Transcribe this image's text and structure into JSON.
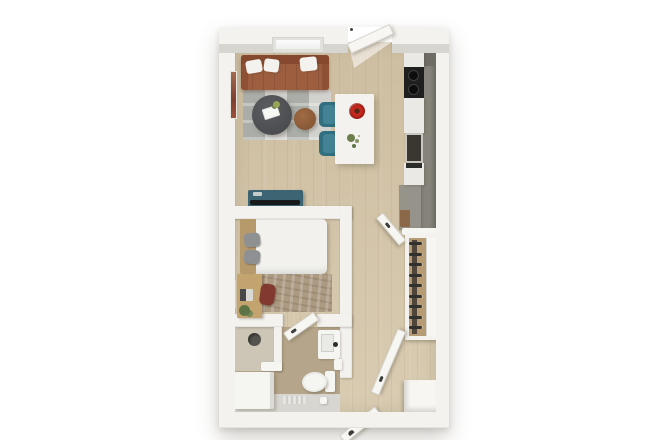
{
  "scene": {
    "description": "3D top-down render of a studio apartment floor plan",
    "background": "#ffffff"
  },
  "palette": {
    "wall": "#edecE8",
    "wallFace": "#f3f2ef",
    "doorWhite": "#f7f6f3",
    "floorA": "#cdbda0",
    "floorB": "#d9ccb2",
    "rugBase": "#c6c6c2",
    "sofa": "#9d5e40",
    "sofaDark": "#86492f",
    "pillow": "#f3f2ee",
    "coffeeTable": "#4e5053",
    "sideTable": "#95643f",
    "chairTeal": "#2f6f80",
    "chairTealLight": "#428294",
    "island": "#f3f2ef",
    "flowerRed": "#c3271d",
    "plantGreen": "#6d7d4b",
    "counter": "#85837a",
    "counterDark": "#6e6c64",
    "counterLow": "#96938a",
    "appliance": "#eae9e5",
    "cooktop": "#1f1f1f",
    "sinkDark": "#39372f",
    "credenza": "#3c6472",
    "tvBlack": "#17191b",
    "headboard": "#b79a6b",
    "duvet": "#f2f1ed",
    "pillowGray": "#8e9091",
    "bedRug": "#ac9a82",
    "desk": "#c4a46e",
    "deskChair": "#82392f",
    "laptopScreen": "#46484a",
    "mirror": "#6f6f6a",
    "bathFloor": "#b5a58a",
    "showerFloor": "#cdc6b7",
    "tileLight": "#d8d6d1",
    "showerHead": "#55534e",
    "hanger": "#30302e",
    "closetWood": "#b59c74",
    "rodShadow": "#50453a",
    "artRed": "#9c5038",
    "fixture": "#f5f5f2"
  },
  "rooms": [
    {
      "id": "living-dining",
      "furniture": [
        "sofa",
        "throw-pillows",
        "plaid-rug",
        "coffee-table",
        "side-table",
        "dining-chairs",
        "island-table",
        "flower-bowl",
        "potted-plant",
        "tv-console",
        "wall-art",
        "window"
      ]
    },
    {
      "id": "kitchen",
      "furniture": [
        "counter-run",
        "cooktop",
        "kitchen-sink",
        "refrigerator",
        "cabinets"
      ]
    },
    {
      "id": "bedroom",
      "furniture": [
        "bed",
        "headboard",
        "gray-pillows",
        "textured-rug",
        "desk",
        "laptop",
        "desk-chair",
        "floor-plant",
        "leaning-mirror",
        "door"
      ]
    },
    {
      "id": "bathroom",
      "furniture": [
        "shower",
        "shower-head",
        "vanity-cabinet",
        "toilet",
        "wall-sink",
        "bath-mat",
        "toilet-paper"
      ]
    },
    {
      "id": "closet",
      "furniture": [
        "hanger-rod",
        "hangers",
        "double-doors",
        "shelf-panel"
      ]
    },
    {
      "id": "entry-hall",
      "furniture": [
        "entry-door",
        "bathroom-door",
        "storage-block"
      ]
    }
  ],
  "closet": {
    "hanger_count": 9,
    "hanger_spacing_px": 10.5
  },
  "cooktop": {
    "burner_count": 2
  }
}
